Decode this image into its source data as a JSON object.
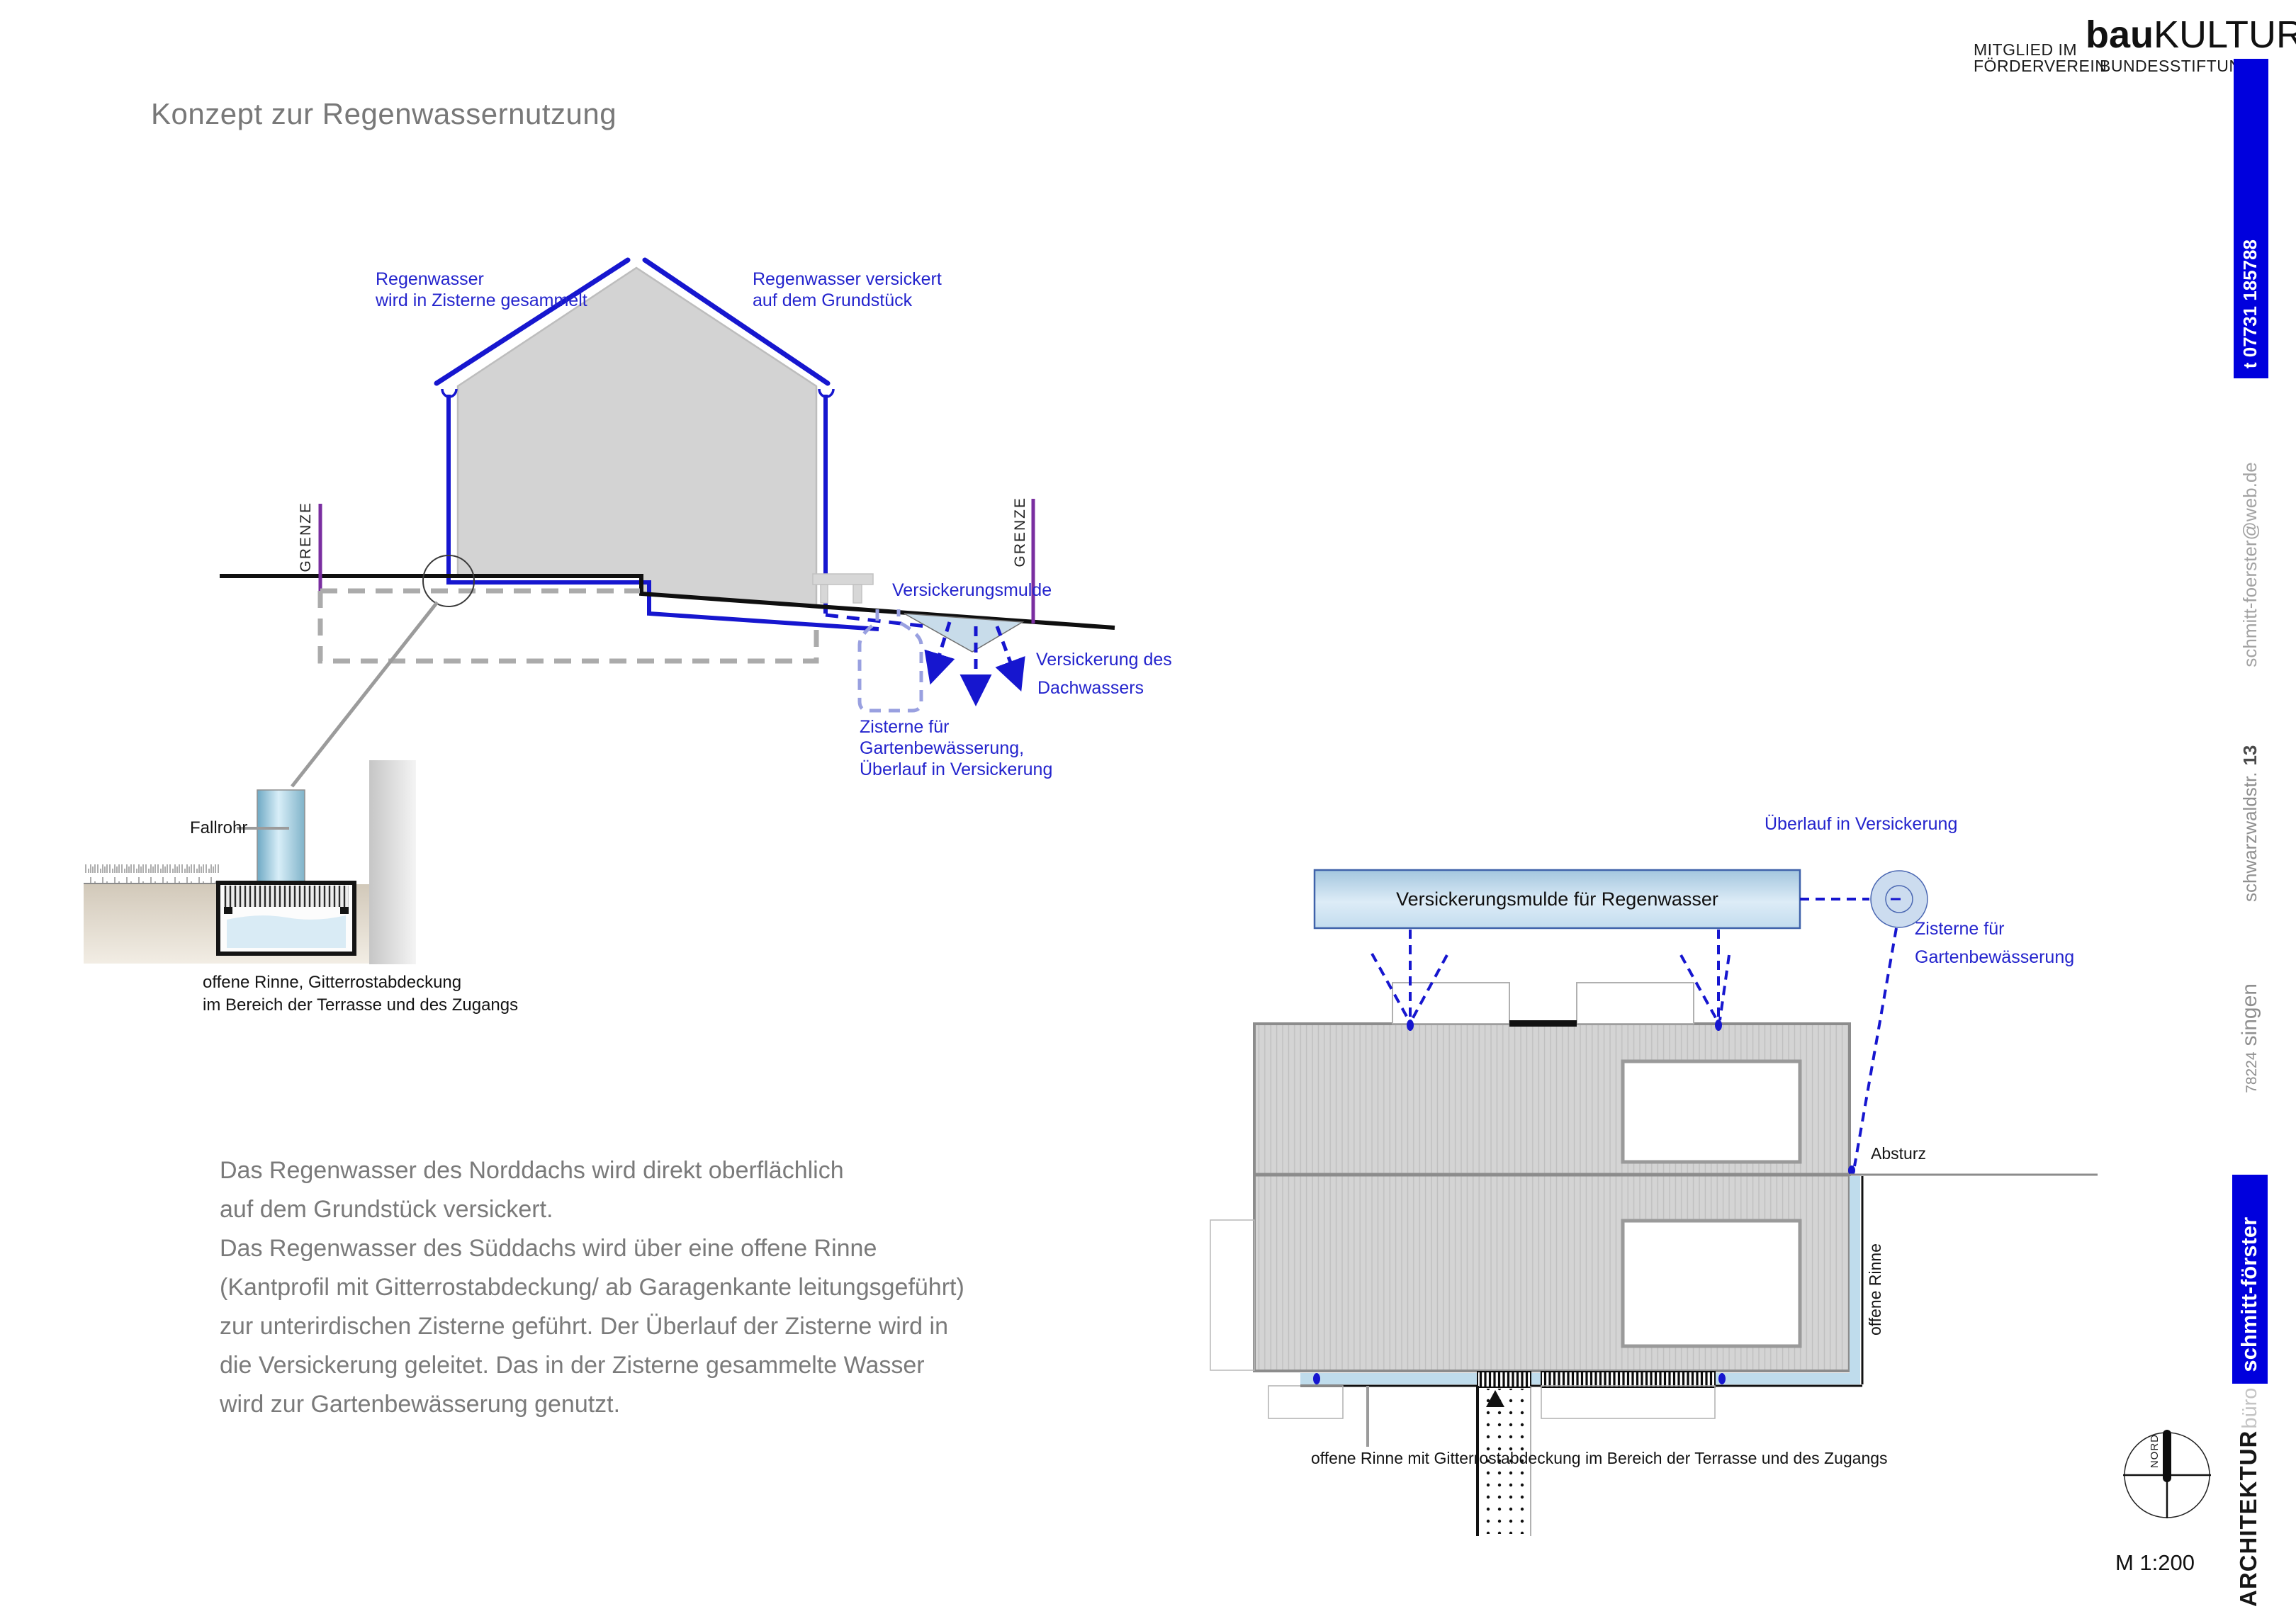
{
  "title": "Konzept zur Regenwassernutzung",
  "logo": {
    "member_line1": "MITGLIED IM",
    "member_line2": "FÖRDERVEREIN",
    "brand_bold": "bau",
    "brand_rest": "KULTUR",
    "foundation": "BUNDESSTIFTUNG"
  },
  "sidebar": {
    "firm_bold": "ARCHITEKTUR",
    "firm_light": "büro",
    "firm_name": "schmitt-förster",
    "zip": "78224",
    "city": "singen",
    "street": "schwarzwaldstr.",
    "street_no": "13",
    "email": "schmitt-foerster@web.de",
    "phone": "t 07731 185788"
  },
  "section": {
    "label_left_1": "Regenwasser",
    "label_left_2": "wird in Zisterne gesammelt",
    "label_right_1": "Regenwasser versickert",
    "label_right_2": "auf dem Grundstück",
    "boundary": "GRENZE",
    "swale_label": "Versickerungsmulde",
    "infiltration_1": "Versickerung des",
    "infiltration_2": "Dachwassers",
    "cistern_1": "Zisterne für",
    "cistern_2": "Gartenbewässerung,",
    "cistern_3": "Überlauf in Versickerung"
  },
  "detail": {
    "downpipe_label": "Fallrohr",
    "caption_1": "offene Rinne, Gitterrostabdeckung",
    "caption_2": "im Bereich der Terrasse und des Zugangs"
  },
  "paragraph": {
    "lines": [
      "Das Regenwasser des Norddachs wird direkt oberflächlich",
      "auf dem Grundstück versickert.",
      "Das Regenwasser des Süddachs wird über eine offene Rinne",
      "(Kantprofil mit Gitterrostabdeckung/ ab Garagenkante leitungsgeführt)",
      "zur unterirdischen Zisterne geführt. Der Überlauf der Zisterne wird in",
      "die Versickerung geleitet. Das in der Zisterne gesammelte Wasser",
      "wird zur Gartenbewässerung genutzt."
    ]
  },
  "plan": {
    "swale_title": "Versickerungsmulde für Regenwasser",
    "overflow_label": "Überlauf in Versickerung",
    "cistern_1": "Zisterne für",
    "cistern_2": "Gartenbewässerung",
    "drop_label": "Absturz",
    "channel_label": "offene Rinne",
    "caption": "offene Rinne mit Gitterrostabdeckung im Bereich der Terrasse und des Zugangs"
  },
  "footer": {
    "north_label": "NORD",
    "scale": "M 1:200"
  },
  "colors": {
    "line_blue": "#1616cf",
    "label_blue": "#2424cd",
    "sidebar_blue": "#0000dd",
    "boundary_purple": "#7a2ea0",
    "cistern_periwinkle": "#99a0e0",
    "light_blue_fill": "#c8dcea",
    "water_blue": "#d9ebf5",
    "roof_gray": "#d4d4d4",
    "text_gray": "#7a7a7a"
  }
}
